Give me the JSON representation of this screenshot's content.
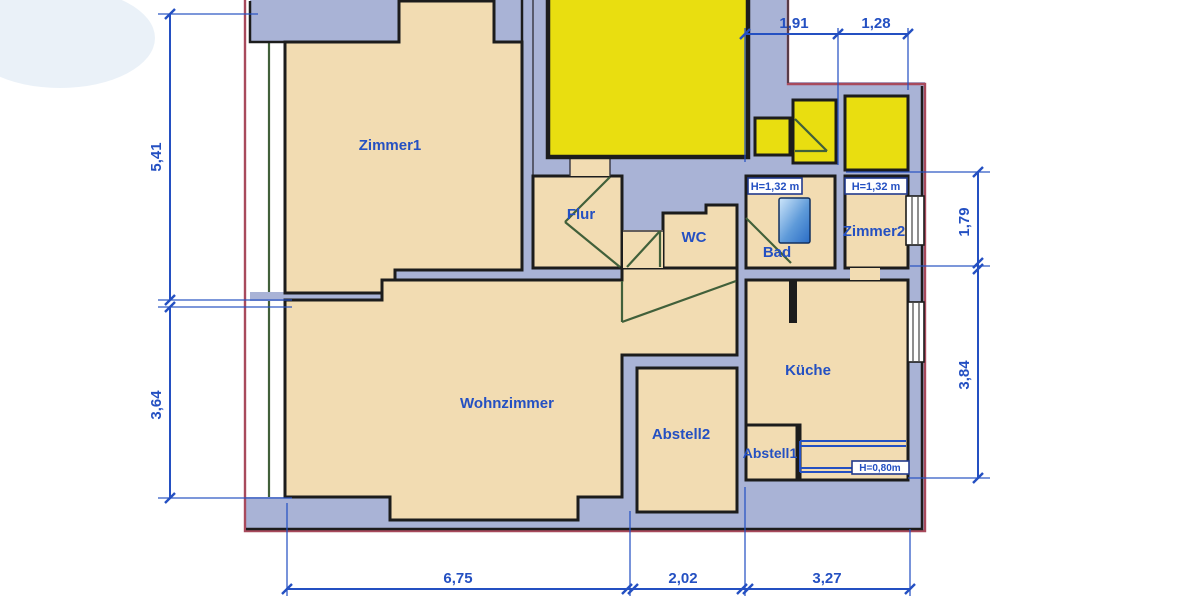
{
  "rooms": {
    "zimmer1": "Zimmer1",
    "flur": "Flur",
    "wc": "WC",
    "bad": "Bad",
    "zimmer2": "Zimmer2",
    "wohnzimmer": "Wohnzimmer",
    "abstell2": "Abstell2",
    "abstell1": "Abstell1",
    "kueche": "Küche"
  },
  "height_notes": {
    "bad": "H=1,32 m",
    "zimmer2": "H=1,32 m",
    "kueche_counter": "H=0,80m"
  },
  "dimensions": {
    "top": [
      "1,91",
      "1,28"
    ],
    "left": [
      "5,41",
      "3,64"
    ],
    "right": [
      "1,79",
      "3,84"
    ],
    "bottom": [
      "6,75",
      "2,02",
      "3,27"
    ]
  },
  "colors": {
    "wall_fill": "#a9b3d6",
    "room_fill": "#f2dcb2",
    "highlight_yellow": "#e9de10",
    "boundary_red": "#a84a5c",
    "dimension_blue": "#2450c2",
    "door_green": "#41603a",
    "wall_line": "#1c1c1c",
    "fixture_blue_light": "#cfe7fb",
    "fixture_blue_dark": "#2a6cc5"
  }
}
